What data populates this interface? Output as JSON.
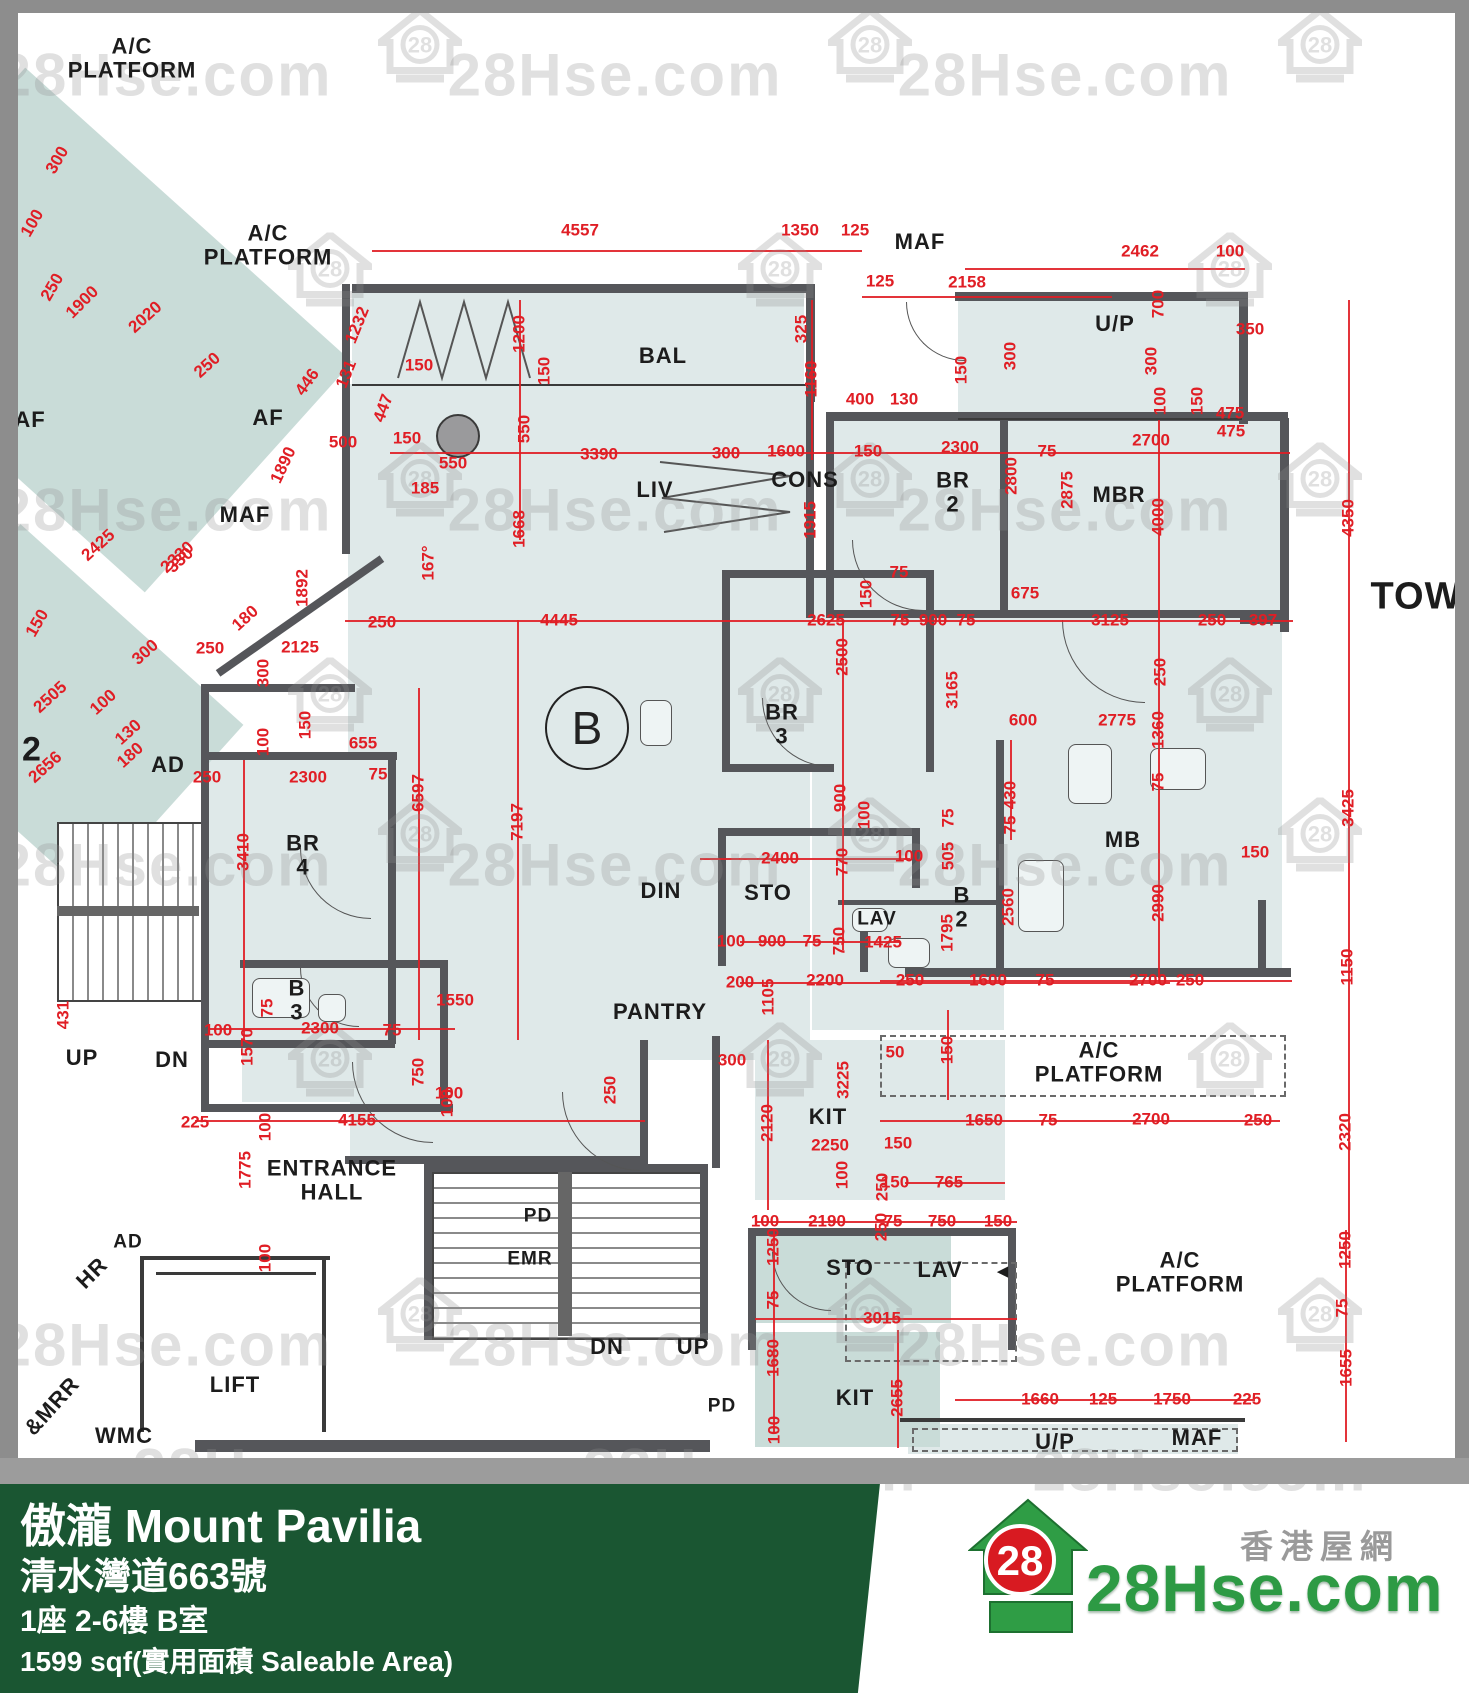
{
  "footer": {
    "title": "傲瀧 Mount Pavilia",
    "address": "清水灣道663號",
    "unit": "1座 2-6樓 B室",
    "area": "1599 sqf(實用面積 Saleable Area)"
  },
  "logo": {
    "badge": "28",
    "brand": "28Hse.com",
    "site_cn": "香港屋網"
  },
  "watermark": {
    "text": "28Hse.com",
    "badge": "28"
  },
  "plan": {
    "unit_badge": "B",
    "room_labels": [
      {
        "t": "A/C PLATFORM",
        "x": 132,
        "y": 58
      },
      {
        "t": "A/C PLATFORM",
        "x": 268,
        "y": 245
      },
      {
        "t": "MAF",
        "x": 920,
        "y": 242
      },
      {
        "t": "U/P",
        "x": 1115,
        "y": 324
      },
      {
        "t": "BAL",
        "x": 663,
        "y": 356
      },
      {
        "t": "AF",
        "x": 30,
        "y": 420
      },
      {
        "t": "AF",
        "x": 268,
        "y": 418
      },
      {
        "t": "MAF",
        "x": 245,
        "y": 515
      },
      {
        "t": "LIV",
        "x": 655,
        "y": 490
      },
      {
        "t": "CONS",
        "x": 805,
        "y": 480
      },
      {
        "t": "BR 2",
        "x": 953,
        "y": 492
      },
      {
        "t": "MBR",
        "x": 1119,
        "y": 495
      },
      {
        "t": "TOW",
        "x": 1416,
        "y": 597,
        "fs": 38
      },
      {
        "t": "BR 3",
        "x": 782,
        "y": 724
      },
      {
        "t": "AD",
        "x": 168,
        "y": 765
      },
      {
        "t": "2",
        "x": 32,
        "y": 750,
        "fs": 34
      },
      {
        "t": "BR 4",
        "x": 303,
        "y": 855
      },
      {
        "t": "DIN",
        "x": 661,
        "y": 891
      },
      {
        "t": "STO",
        "x": 768,
        "y": 893
      },
      {
        "t": "LAV",
        "x": 877,
        "y": 920,
        "fs": 19
      },
      {
        "t": "B 2",
        "x": 962,
        "y": 907
      },
      {
        "t": "MB",
        "x": 1123,
        "y": 840
      },
      {
        "t": "PANTRY",
        "x": 660,
        "y": 1012
      },
      {
        "t": "B 3",
        "x": 297,
        "y": 1000
      },
      {
        "t": "UP",
        "x": 82,
        "y": 1058
      },
      {
        "t": "DN",
        "x": 172,
        "y": 1060
      },
      {
        "t": "KIT",
        "x": 828,
        "y": 1117
      },
      {
        "t": "A/C PLATFORM",
        "x": 1099,
        "y": 1062
      },
      {
        "t": "ENTRANCE\nHALL",
        "x": 332,
        "y": 1180
      },
      {
        "t": "PD",
        "x": 538,
        "y": 1217,
        "fs": 19
      },
      {
        "t": "EMR",
        "x": 530,
        "y": 1260,
        "fs": 19
      },
      {
        "t": "AD",
        "x": 128,
        "y": 1243,
        "fs": 19
      },
      {
        "t": "HR",
        "x": 92,
        "y": 1273,
        "r": -45
      },
      {
        "t": "LIFT",
        "x": 235,
        "y": 1385
      },
      {
        "t": "WMC",
        "x": 124,
        "y": 1436
      },
      {
        "t": "&MRR",
        "x": 52,
        "y": 1406,
        "r": -48
      },
      {
        "t": "DN",
        "x": 607,
        "y": 1347
      },
      {
        "t": "UP",
        "x": 693,
        "y": 1347
      },
      {
        "t": "STO",
        "x": 850,
        "y": 1268
      },
      {
        "t": "LAV",
        "x": 940,
        "y": 1270
      },
      {
        "t": "A/C PLATFORM",
        "x": 1180,
        "y": 1272
      },
      {
        "t": "◄",
        "x": 1003,
        "y": 1273,
        "fs": 19
      },
      {
        "t": "KIT",
        "x": 855,
        "y": 1398
      },
      {
        "t": "PD",
        "x": 722,
        "y": 1407,
        "fs": 19
      },
      {
        "t": "U/P",
        "x": 1055,
        "y": 1442
      },
      {
        "t": "MAF",
        "x": 1197,
        "y": 1438
      }
    ],
    "dim_labels": [
      {
        "t": "4557",
        "x": 580,
        "y": 230
      },
      {
        "t": "1350",
        "x": 800,
        "y": 230
      },
      {
        "t": "125",
        "x": 855,
        "y": 230
      },
      {
        "t": "2462",
        "x": 1140,
        "y": 251
      },
      {
        "t": "100",
        "x": 1230,
        "y": 251
      },
      {
        "t": "125",
        "x": 880,
        "y": 281
      },
      {
        "t": "2158",
        "x": 967,
        "y": 282
      },
      {
        "t": "350",
        "x": 1250,
        "y": 329
      },
      {
        "t": "1232",
        "x": 357,
        "y": 325,
        "r": -68
      },
      {
        "t": "131",
        "x": 346,
        "y": 374,
        "r": -68
      },
      {
        "t": "150",
        "x": 419,
        "y": 365
      },
      {
        "t": "447",
        "x": 383,
        "y": 408,
        "r": -70
      },
      {
        "t": "446",
        "x": 307,
        "y": 382,
        "r": -55
      },
      {
        "t": "500",
        "x": 343,
        "y": 442
      },
      {
        "t": "150",
        "x": 407,
        "y": 438
      },
      {
        "t": "1890",
        "x": 283,
        "y": 465,
        "r": -65
      },
      {
        "t": "550",
        "x": 453,
        "y": 463
      },
      {
        "t": "185",
        "x": 425,
        "y": 488
      },
      {
        "t": "167°",
        "x": 428,
        "y": 563,
        "r": -90
      },
      {
        "t": "1200",
        "x": 519,
        "y": 334,
        "r": -90
      },
      {
        "t": "150",
        "x": 544,
        "y": 371,
        "r": -90
      },
      {
        "t": "550",
        "x": 524,
        "y": 429,
        "r": -90
      },
      {
        "t": "3390",
        "x": 599,
        "y": 454
      },
      {
        "t": "300",
        "x": 726,
        "y": 453
      },
      {
        "t": "1600",
        "x": 786,
        "y": 451
      },
      {
        "t": "150",
        "x": 868,
        "y": 451
      },
      {
        "t": "325",
        "x": 801,
        "y": 329,
        "r": -90
      },
      {
        "t": "1160",
        "x": 811,
        "y": 379,
        "r": -90
      },
      {
        "t": "400",
        "x": 860,
        "y": 399
      },
      {
        "t": "130",
        "x": 904,
        "y": 399
      },
      {
        "t": "150",
        "x": 961,
        "y": 370,
        "r": -90
      },
      {
        "t": "300",
        "x": 1010,
        "y": 356,
        "r": -90
      },
      {
        "t": "700",
        "x": 1158,
        "y": 304,
        "r": -90
      },
      {
        "t": "300",
        "x": 1151,
        "y": 361,
        "r": -90
      },
      {
        "t": "100",
        "x": 1160,
        "y": 401,
        "r": -90
      },
      {
        "t": "150",
        "x": 1197,
        "y": 401,
        "r": -90
      },
      {
        "t": "475",
        "x": 1231,
        "y": 431
      },
      {
        "t": "2300",
        "x": 960,
        "y": 447
      },
      {
        "t": "75",
        "x": 1047,
        "y": 451
      },
      {
        "t": "2700",
        "x": 1151,
        "y": 440
      },
      {
        "t": "2800",
        "x": 1011,
        "y": 476,
        "r": -90
      },
      {
        "t": "2875",
        "x": 1067,
        "y": 490,
        "r": -90
      },
      {
        "t": "1915",
        "x": 810,
        "y": 520,
        "r": -90
      },
      {
        "t": "150",
        "x": 866,
        "y": 594,
        "r": -90
      },
      {
        "t": "75",
        "x": 899,
        "y": 572
      },
      {
        "t": "1668",
        "x": 519,
        "y": 529,
        "r": -90
      },
      {
        "t": "1892",
        "x": 302,
        "y": 588,
        "r": -90
      },
      {
        "t": "250",
        "x": 382,
        "y": 622
      },
      {
        "t": "2125",
        "x": 300,
        "y": 647
      },
      {
        "t": "250",
        "x": 210,
        "y": 648
      },
      {
        "t": "300",
        "x": 263,
        "y": 673,
        "r": -90
      },
      {
        "t": "150",
        "x": 305,
        "y": 725,
        "r": -90
      },
      {
        "t": "100",
        "x": 263,
        "y": 742,
        "r": -90
      },
      {
        "t": "655",
        "x": 363,
        "y": 743
      },
      {
        "t": "2300",
        "x": 308,
        "y": 777
      },
      {
        "t": "75",
        "x": 378,
        "y": 774
      },
      {
        "t": "3410",
        "x": 243,
        "y": 852,
        "r": -90
      },
      {
        "t": "6597",
        "x": 418,
        "y": 793,
        "r": -90
      },
      {
        "t": "7197",
        "x": 517,
        "y": 822,
        "r": -90
      },
      {
        "t": "4445",
        "x": 559,
        "y": 620
      },
      {
        "t": "2625",
        "x": 826,
        "y": 620
      },
      {
        "t": "75",
        "x": 900,
        "y": 620
      },
      {
        "t": "900",
        "x": 933,
        "y": 620
      },
      {
        "t": "75",
        "x": 966,
        "y": 620
      },
      {
        "t": "675",
        "x": 1025,
        "y": 593
      },
      {
        "t": "3125",
        "x": 1110,
        "y": 620
      },
      {
        "t": "250",
        "x": 1212,
        "y": 620
      },
      {
        "t": "397",
        "x": 1263,
        "y": 620
      },
      {
        "t": "2500",
        "x": 842,
        "y": 657,
        "r": -90
      },
      {
        "t": "3165",
        "x": 952,
        "y": 690,
        "r": -90
      },
      {
        "t": "600",
        "x": 1023,
        "y": 720
      },
      {
        "t": "2775",
        "x": 1117,
        "y": 720
      },
      {
        "t": "1360",
        "x": 1158,
        "y": 730,
        "r": -90
      },
      {
        "t": "250",
        "x": 1160,
        "y": 672,
        "r": -90
      },
      {
        "t": "75",
        "x": 1158,
        "y": 782,
        "r": -90
      },
      {
        "t": "430",
        "x": 1010,
        "y": 795,
        "r": -90
      },
      {
        "t": "75",
        "x": 1010,
        "y": 825,
        "r": -90
      },
      {
        "t": "505",
        "x": 948,
        "y": 856,
        "r": -90
      },
      {
        "t": "75",
        "x": 948,
        "y": 818,
        "r": -90
      },
      {
        "t": "100",
        "x": 909,
        "y": 856
      },
      {
        "t": "900",
        "x": 840,
        "y": 798,
        "r": -90
      },
      {
        "t": "100",
        "x": 864,
        "y": 815,
        "r": -90
      },
      {
        "t": "2400",
        "x": 780,
        "y": 858
      },
      {
        "t": "770",
        "x": 842,
        "y": 862,
        "r": -90
      },
      {
        "t": "750",
        "x": 839,
        "y": 941,
        "r": -90
      },
      {
        "t": "100",
        "x": 731,
        "y": 941
      },
      {
        "t": "900",
        "x": 772,
        "y": 941
      },
      {
        "t": "75",
        "x": 812,
        "y": 941
      },
      {
        "t": "1425",
        "x": 883,
        "y": 942
      },
      {
        "t": "1795",
        "x": 947,
        "y": 933,
        "r": -90
      },
      {
        "t": "2560",
        "x": 1008,
        "y": 907,
        "r": -90
      },
      {
        "t": "2990",
        "x": 1158,
        "y": 903,
        "r": -90
      },
      {
        "t": "150",
        "x": 1255,
        "y": 852
      },
      {
        "t": "250",
        "x": 910,
        "y": 980
      },
      {
        "t": "1600",
        "x": 988,
        "y": 980
      },
      {
        "t": "75",
        "x": 1045,
        "y": 980
      },
      {
        "t": "2700",
        "x": 1148,
        "y": 980
      },
      {
        "t": "250",
        "x": 1190,
        "y": 980
      },
      {
        "t": "4000",
        "x": 1158,
        "y": 517,
        "r": -90
      },
      {
        "t": "4350",
        "x": 1348,
        "y": 518,
        "r": -90
      },
      {
        "t": "475",
        "x": 1230,
        "y": 413
      },
      {
        "t": "3425",
        "x": 1348,
        "y": 808,
        "r": -90
      },
      {
        "t": "50",
        "x": 895,
        "y": 1052
      },
      {
        "t": "150",
        "x": 947,
        "y": 1050,
        "r": -90
      },
      {
        "t": "1650",
        "x": 984,
        "y": 1120
      },
      {
        "t": "75",
        "x": 1048,
        "y": 1120
      },
      {
        "t": "2700",
        "x": 1151,
        "y": 1119
      },
      {
        "t": "250",
        "x": 1258,
        "y": 1120
      },
      {
        "t": "1150",
        "x": 1347,
        "y": 967,
        "r": -90
      },
      {
        "t": "2320",
        "x": 1345,
        "y": 1132,
        "r": -90
      },
      {
        "t": "150",
        "x": 895,
        "y": 1182
      },
      {
        "t": "765",
        "x": 949,
        "y": 1182
      },
      {
        "t": "250",
        "x": 881,
        "y": 1227,
        "r": -90
      },
      {
        "t": "100",
        "x": 765,
        "y": 1221
      },
      {
        "t": "2190",
        "x": 827,
        "y": 1221
      },
      {
        "t": "75",
        "x": 893,
        "y": 1221
      },
      {
        "t": "750",
        "x": 942,
        "y": 1221
      },
      {
        "t": "150",
        "x": 998,
        "y": 1221
      },
      {
        "t": "1250",
        "x": 773,
        "y": 1247,
        "r": -90
      },
      {
        "t": "75",
        "x": 773,
        "y": 1300,
        "r": -90
      },
      {
        "t": "3015",
        "x": 882,
        "y": 1318
      },
      {
        "t": "1680",
        "x": 773,
        "y": 1358,
        "r": -90
      },
      {
        "t": "100",
        "x": 774,
        "y": 1430,
        "r": -90
      },
      {
        "t": "2655",
        "x": 897,
        "y": 1398,
        "r": -90
      },
      {
        "t": "1660",
        "x": 1040,
        "y": 1399
      },
      {
        "t": "125",
        "x": 1103,
        "y": 1399
      },
      {
        "t": "1750",
        "x": 1172,
        "y": 1399
      },
      {
        "t": "225",
        "x": 1247,
        "y": 1399
      },
      {
        "t": "1250",
        "x": 1345,
        "y": 1250,
        "r": -90
      },
      {
        "t": "75",
        "x": 1342,
        "y": 1308,
        "r": -90
      },
      {
        "t": "1655",
        "x": 1346,
        "y": 1368,
        "r": -90
      },
      {
        "t": "431",
        "x": 63,
        "y": 1015,
        "r": -90
      },
      {
        "t": "100",
        "x": 218,
        "y": 1030
      },
      {
        "t": "75",
        "x": 267,
        "y": 1008,
        "r": -90
      },
      {
        "t": "1570",
        "x": 247,
        "y": 1047,
        "r": -90
      },
      {
        "t": "2300",
        "x": 320,
        "y": 1028
      },
      {
        "t": "75",
        "x": 392,
        "y": 1030
      },
      {
        "t": "750",
        "x": 418,
        "y": 1072,
        "r": -90
      },
      {
        "t": "100",
        "x": 447,
        "y": 1103,
        "r": -90
      },
      {
        "t": "225",
        "x": 195,
        "y": 1122
      },
      {
        "t": "100",
        "x": 265,
        "y": 1127,
        "r": -90
      },
      {
        "t": "4155",
        "x": 357,
        "y": 1120
      },
      {
        "t": "1775",
        "x": 245,
        "y": 1170,
        "r": -90
      },
      {
        "t": "100",
        "x": 265,
        "y": 1258,
        "r": -90
      },
      {
        "t": "1550",
        "x": 455,
        "y": 1000
      },
      {
        "t": "100",
        "x": 449,
        "y": 1093
      },
      {
        "t": "250",
        "x": 610,
        "y": 1090,
        "r": -90
      },
      {
        "t": "300",
        "x": 732,
        "y": 1060
      },
      {
        "t": "200",
        "x": 740,
        "y": 982
      },
      {
        "t": "2200",
        "x": 825,
        "y": 980
      },
      {
        "t": "1105",
        "x": 768,
        "y": 997,
        "r": -90
      },
      {
        "t": "3225",
        "x": 843,
        "y": 1080,
        "r": -90
      },
      {
        "t": "2120",
        "x": 767,
        "y": 1123,
        "r": -90
      },
      {
        "t": "2250",
        "x": 830,
        "y": 1145
      },
      {
        "t": "150",
        "x": 898,
        "y": 1143
      },
      {
        "t": "100",
        "x": 842,
        "y": 1175,
        "r": -90
      },
      {
        "t": "250",
        "x": 882,
        "y": 1187,
        "r": -90
      },
      {
        "t": "300",
        "x": 57,
        "y": 160,
        "r": -60
      },
      {
        "t": "100",
        "x": 32,
        "y": 223,
        "r": -60
      },
      {
        "t": "250",
        "x": 52,
        "y": 287,
        "r": -60
      },
      {
        "t": "1900",
        "x": 82,
        "y": 302,
        "r": -45
      },
      {
        "t": "2020",
        "x": 145,
        "y": 317,
        "r": -42
      },
      {
        "t": "250",
        "x": 207,
        "y": 365,
        "r": -42
      },
      {
        "t": "2505",
        "x": 50,
        "y": 697,
        "r": -42
      },
      {
        "t": "2656",
        "x": 45,
        "y": 767,
        "r": -42
      },
      {
        "t": "2425",
        "x": 98,
        "y": 545,
        "r": -42
      },
      {
        "t": "2330",
        "x": 177,
        "y": 557,
        "r": -42
      },
      {
        "t": "180",
        "x": 245,
        "y": 618,
        "r": -42
      },
      {
        "t": "300",
        "x": 145,
        "y": 652,
        "r": -42
      },
      {
        "t": "100",
        "x": 103,
        "y": 702,
        "r": -42
      },
      {
        "t": "130",
        "x": 128,
        "y": 732,
        "r": -42
      },
      {
        "t": "180",
        "x": 130,
        "y": 755,
        "r": -42
      },
      {
        "t": "150",
        "x": 37,
        "y": 623,
        "r": -60
      },
      {
        "t": "250",
        "x": 207,
        "y": 777
      },
      {
        "t": "330",
        "x": 180,
        "y": 560,
        "r": -42
      }
    ]
  }
}
